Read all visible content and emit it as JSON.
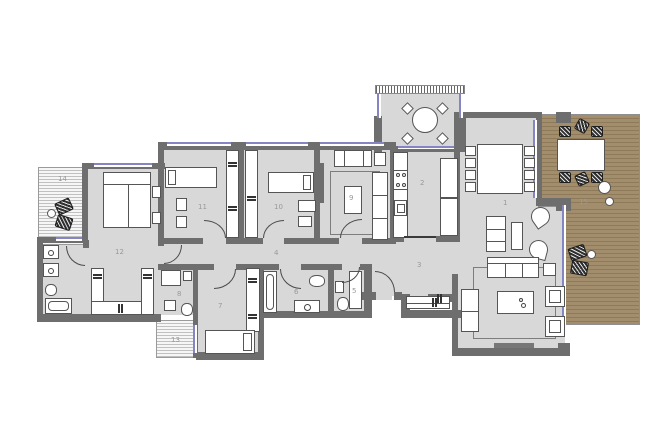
{
  "title": "apartment-floor-plan",
  "colors": {
    "background": "#ffffff",
    "room_fill": "#d8d8d8",
    "wall": "#6e6e6e",
    "window": "#8585c4",
    "deck_fill": "#a28d6c",
    "deck_stripe": "#8e7958",
    "furniture_fill": "#ffffff",
    "furniture_outline": "#555555",
    "outdoor_furniture": "#2f2f2f",
    "label_color": "#999999"
  },
  "rooms": [
    {
      "label": "1"
    },
    {
      "label": "2"
    },
    {
      "label": "3"
    },
    {
      "label": "4"
    },
    {
      "label": "5"
    },
    {
      "label": "6"
    },
    {
      "label": "7"
    },
    {
      "label": "8"
    },
    {
      "label": "9"
    },
    {
      "label": "10"
    },
    {
      "label": "11"
    },
    {
      "label": "12"
    },
    {
      "label": "13"
    },
    {
      "label": "14"
    },
    {
      "label": "15"
    }
  ]
}
